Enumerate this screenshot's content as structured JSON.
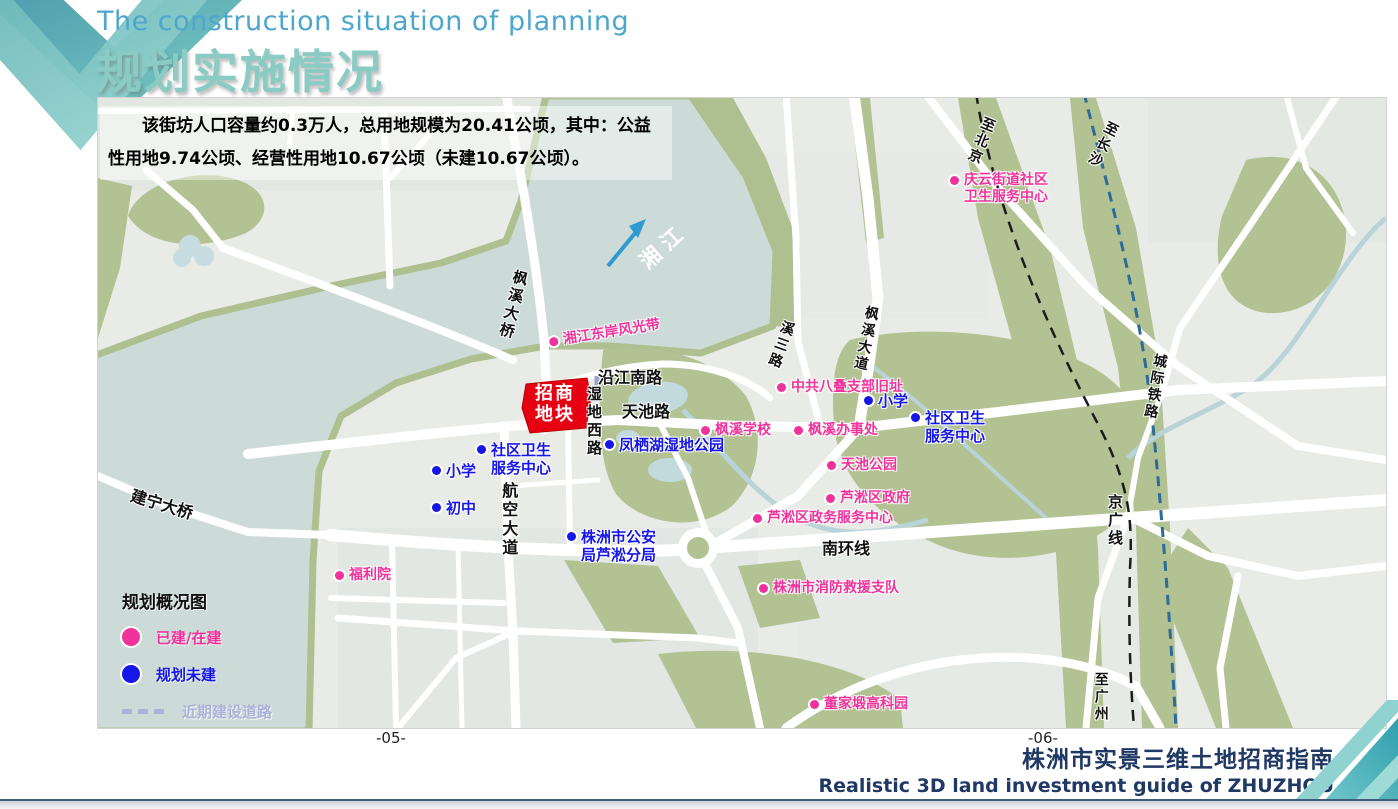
{
  "header": {
    "title_en": "The construction situation of planning",
    "title_cn": "规划实施情况"
  },
  "infobox": {
    "text": "该街坊人口容量约0.3万人，总用地规模为20.41公顷，其中：公益性用地9.74公顷、经营性用地10.67公顷（未建10.67公顷）。"
  },
  "legend": {
    "title": "规划概况图",
    "items": [
      {
        "label": "已建/在建",
        "color": "#f0339b",
        "type": "circle"
      },
      {
        "label": "规划未建",
        "color": "#1616e8",
        "type": "circle"
      },
      {
        "label": "近期建设道路",
        "color": "#a9b2d8",
        "type": "dash"
      }
    ]
  },
  "map": {
    "colors": {
      "pink": "#f0339b",
      "blue": "#1616e8",
      "road": "#111111",
      "white": "#ffffff",
      "water": "#cddbd8",
      "green": "#b2c293",
      "parcel_red": "#e70012",
      "lavender": "#a9b2d8"
    },
    "labels": [
      {
        "name": "fengxi-bridge",
        "text": "枫溪大桥",
        "type": "road",
        "x": 415,
        "y": 170,
        "size": 15,
        "vertical": true,
        "rotate": 14
      },
      {
        "name": "jianning-bridge",
        "text": "建宁大桥",
        "type": "road",
        "x": 36,
        "y": 388,
        "size": 16,
        "rotate": 17
      },
      {
        "name": "yanjiang-south-road",
        "text": "沿江南路",
        "type": "road",
        "x": 500,
        "y": 270,
        "size": 16
      },
      {
        "name": "shidi-west-road",
        "text": "湿地西路",
        "type": "road",
        "x": 487,
        "y": 288,
        "size": 15,
        "vertical": true
      },
      {
        "name": "tianchi-road",
        "text": "天池路",
        "type": "road",
        "x": 524,
        "y": 304,
        "size": 16
      },
      {
        "name": "hangkong-avenue",
        "text": "航空大道",
        "type": "road",
        "x": 401,
        "y": 384,
        "size": 16,
        "vertical": true
      },
      {
        "name": "nanhuan-line",
        "text": "南环线",
        "type": "road",
        "x": 724,
        "y": 441,
        "size": 16
      },
      {
        "name": "xisan-road",
        "text": "溪三路",
        "type": "road",
        "x": 683,
        "y": 220,
        "size": 14,
        "vertical": true,
        "rotate": 20
      },
      {
        "name": "fengxi-avenue",
        "text": "枫溪大道",
        "type": "road",
        "x": 766,
        "y": 206,
        "size": 14,
        "vertical": true,
        "rotate": 12
      },
      {
        "name": "jingguang-line",
        "text": "京广线",
        "type": "road",
        "x": 1008,
        "y": 396,
        "size": 15,
        "vertical": true
      },
      {
        "name": "chengji-railway",
        "text": "城际铁路",
        "type": "road",
        "x": 1054,
        "y": 254,
        "size": 14,
        "vertical": true,
        "rotate": 10
      },
      {
        "name": "to-beijing",
        "text": "至北京",
        "type": "road",
        "x": 884,
        "y": 16,
        "size": 14,
        "vertical": true,
        "rotate": 22
      },
      {
        "name": "to-changsha",
        "text": "至长沙",
        "type": "road",
        "x": 1008,
        "y": 20,
        "size": 14,
        "vertical": true,
        "rotate": 27
      },
      {
        "name": "to-guangzhou",
        "text": "至广州",
        "type": "road",
        "x": 994,
        "y": 574,
        "size": 14,
        "vertical": true
      },
      {
        "name": "xiangjiang-river",
        "text": "湘江",
        "type": "river",
        "x": 537,
        "y": 158,
        "size": 21,
        "rotate": -42
      },
      {
        "name": "xiangjiang-east-bank",
        "text": "湘江东岸风光带",
        "type": "pink",
        "x": 450,
        "y": 236,
        "size": 14,
        "dot": true,
        "rotate": -9
      },
      {
        "name": "qingyun-health-center",
        "text": "庆云街道社区\n卫生服务中心",
        "type": "pink",
        "x": 852,
        "y": 74,
        "size": 14,
        "dot": true
      },
      {
        "name": "badie-branch-site",
        "text": "中共八叠支部旧址",
        "type": "pink",
        "x": 679,
        "y": 281,
        "size": 14,
        "dot": true
      },
      {
        "name": "fengxi-school",
        "text": "枫溪学校",
        "type": "pink",
        "x": 603,
        "y": 324,
        "size": 14,
        "dot": true
      },
      {
        "name": "fengxi-office",
        "text": "枫溪办事处",
        "type": "pink",
        "x": 696,
        "y": 324,
        "size": 14,
        "dot": true
      },
      {
        "name": "tianchi-park",
        "text": "天池公园",
        "type": "pink",
        "x": 729,
        "y": 359,
        "size": 14,
        "dot": true
      },
      {
        "name": "lusong-district-gov",
        "text": "芦淞区政府",
        "type": "pink",
        "x": 728,
        "y": 392,
        "size": 14,
        "dot": true
      },
      {
        "name": "lusong-service-center",
        "text": "芦淞区政务服务中心",
        "type": "pink",
        "x": 655,
        "y": 412,
        "size": 14,
        "dot": true
      },
      {
        "name": "fire-rescue-brigade",
        "text": "株洲市消防救援支队",
        "type": "pink",
        "x": 661,
        "y": 482,
        "size": 14,
        "dot": true
      },
      {
        "name": "welfare-house",
        "text": "福利院",
        "type": "pink",
        "x": 237,
        "y": 469,
        "size": 14,
        "dot": true
      },
      {
        "name": "dongjiaduan-tech-park",
        "text": "董家塅高科园",
        "type": "pink",
        "x": 712,
        "y": 598,
        "size": 14,
        "dot": true
      },
      {
        "name": "primary-school-ne",
        "text": "小学",
        "type": "blue",
        "x": 766,
        "y": 294,
        "size": 15,
        "dot": true
      },
      {
        "name": "community-health-e",
        "text": "社区卫生\n服务中心",
        "type": "blue",
        "x": 813,
        "y": 311,
        "size": 15,
        "dot": true
      },
      {
        "name": "fengqi-lake-wetland-park",
        "text": "凤栖湖湿地公园",
        "type": "blue",
        "x": 507,
        "y": 338,
        "size": 15,
        "dot": true
      },
      {
        "name": "community-health-w",
        "text": "社区卫生\n服务中心",
        "type": "blue",
        "x": 379,
        "y": 343,
        "size": 15,
        "dot": true
      },
      {
        "name": "primary-school-w",
        "text": "小学",
        "type": "blue",
        "x": 334,
        "y": 364,
        "size": 15,
        "dot": true
      },
      {
        "name": "middle-school",
        "text": "初中",
        "type": "blue",
        "x": 334,
        "y": 401,
        "size": 15,
        "dot": true
      },
      {
        "name": "police-lusong-branch",
        "text": "株洲市公安\n局芦淞分局",
        "type": "blue",
        "x": 469,
        "y": 430,
        "size": 15,
        "dot": true
      },
      {
        "name": "investment-parcel",
        "text": "招商\n地块",
        "type": "white",
        "x": 437,
        "y": 286,
        "size": 18
      }
    ]
  },
  "pages": {
    "left": "-05-",
    "right": "-06-"
  },
  "footer": {
    "title_cn": "株洲市实景三维土地招商指南",
    "title_en": "Realistic 3D land investment guide of ZHUZHOU"
  }
}
